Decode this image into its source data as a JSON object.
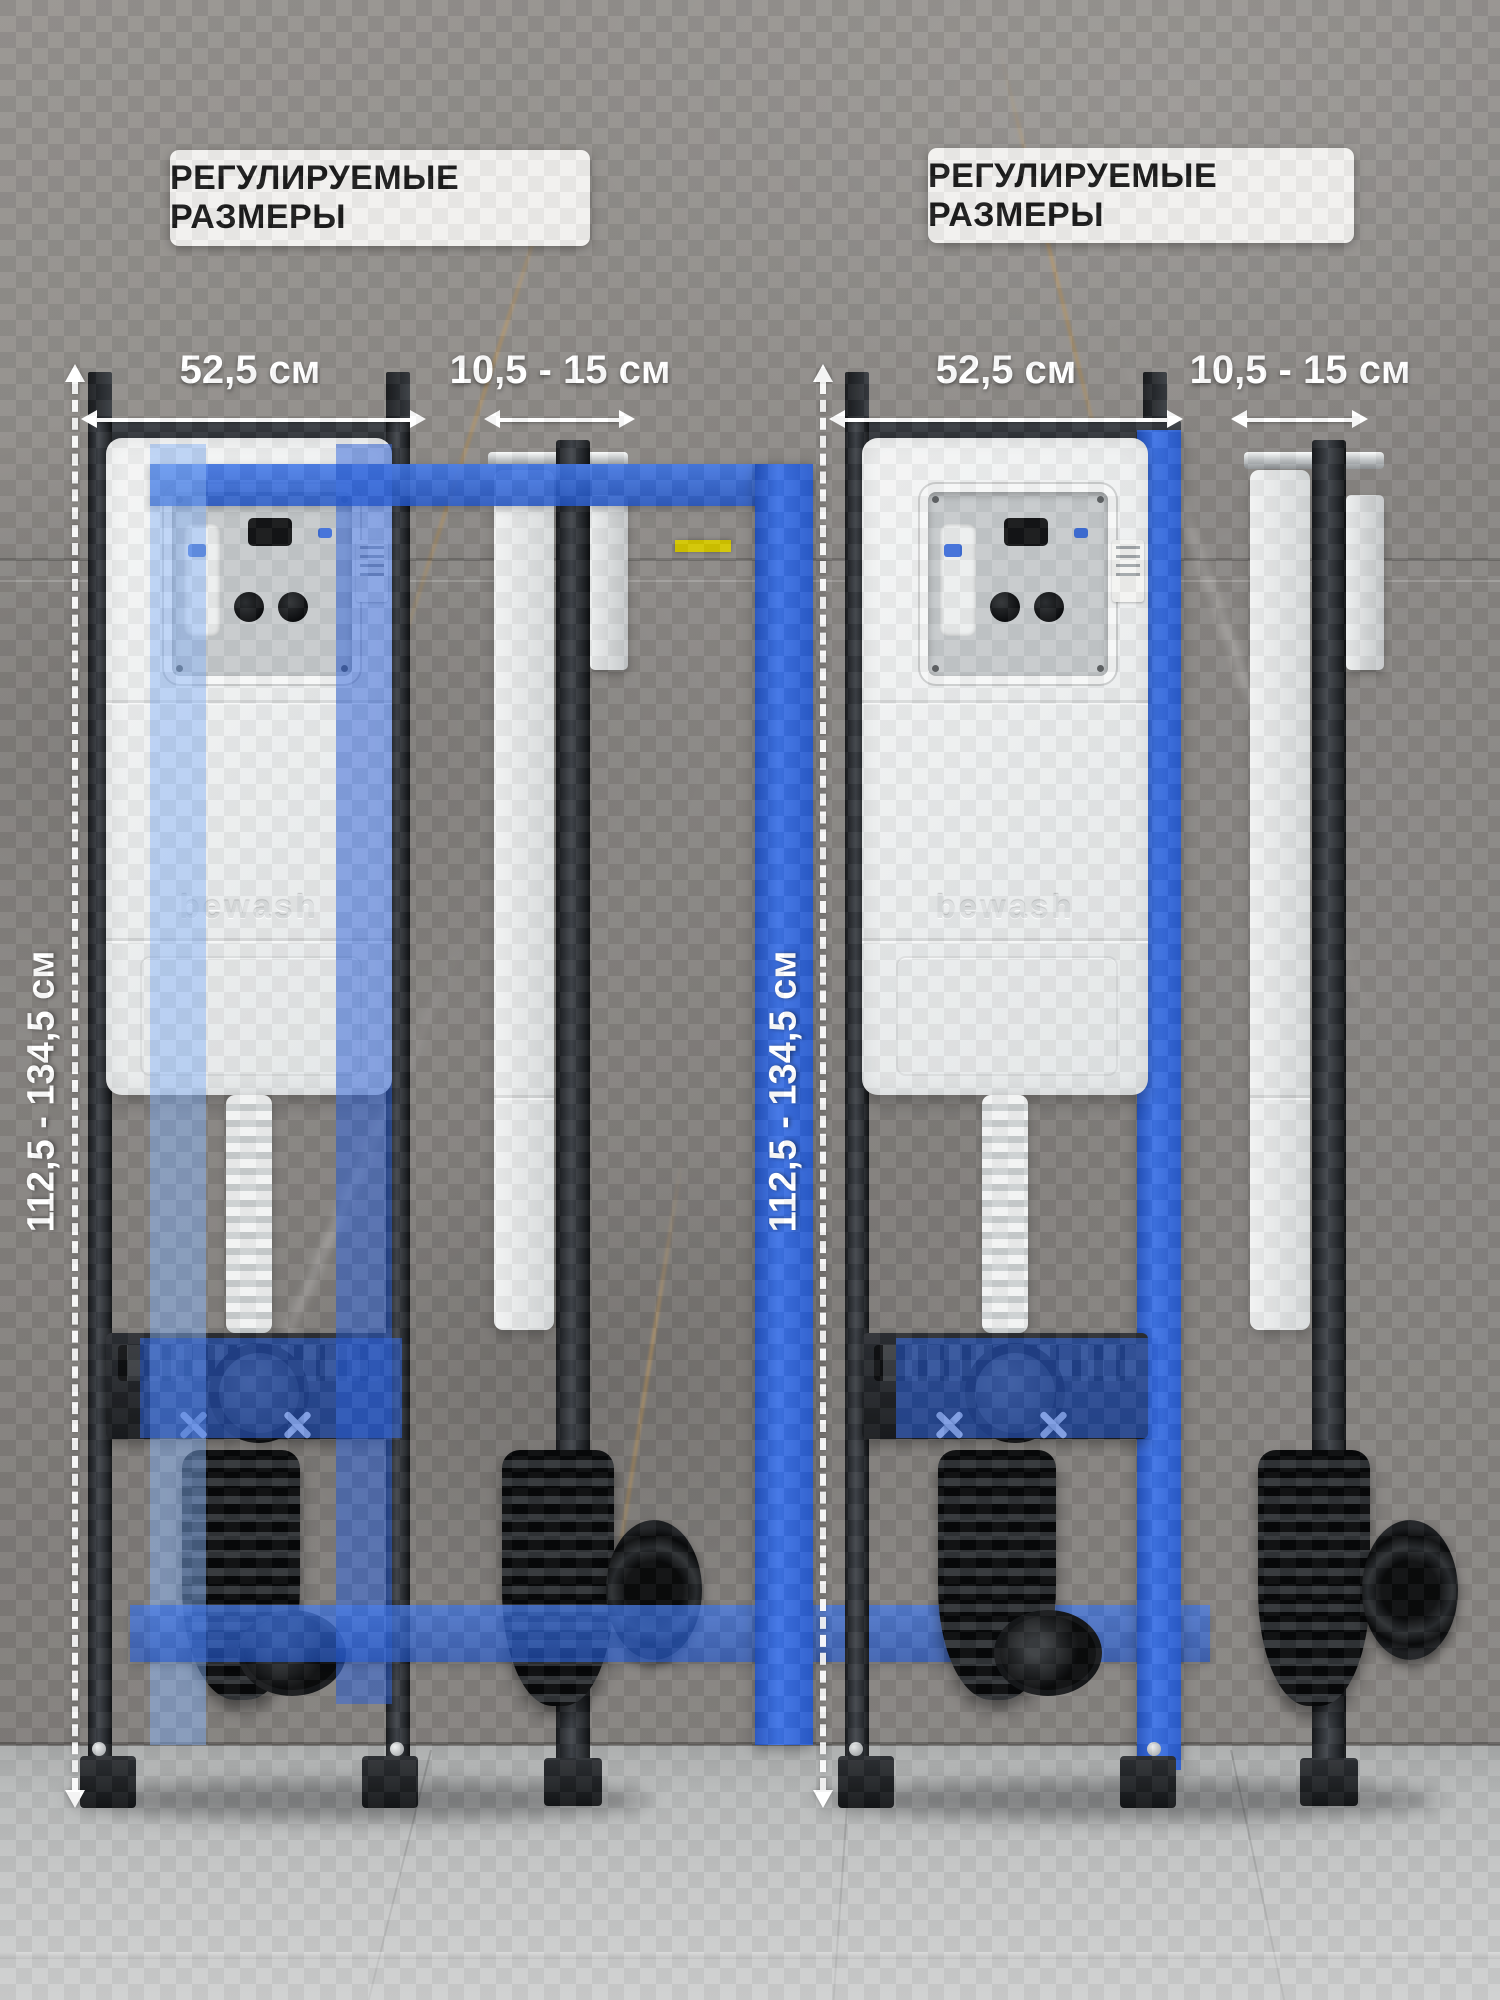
{
  "banners": {
    "left": "РЕГУЛИРУЕМЫЕ РАЗМЕРЫ",
    "right": "РЕГУЛИРУЕМЫЕ РАЗМЕРЫ"
  },
  "groups": [
    {
      "width_dim": "52,5 см",
      "depth_dim": "10,5 - 15 см",
      "height_dim": "112,5 - 134,5 см",
      "cistern_logo": "bewash"
    },
    {
      "width_dim": "52,5 см",
      "depth_dim": "10,5 - 15 см",
      "height_dim": "112,5 - 134,5 см",
      "cistern_logo": "bewash"
    }
  ],
  "colors": {
    "accent_blue": "#2e63d8",
    "light_blue_overlay": "#85b2f5",
    "highlight_yellow": "#d2c500",
    "frame_dark": "#26292d",
    "cistern_white": "#eef0f0",
    "wall_gray": "#8b8885",
    "floor_gray": "#c7c8c8",
    "dimension_white": "#ffffff",
    "banner_bg": "#f1f0ee",
    "banner_text": "#1b1b1b"
  }
}
